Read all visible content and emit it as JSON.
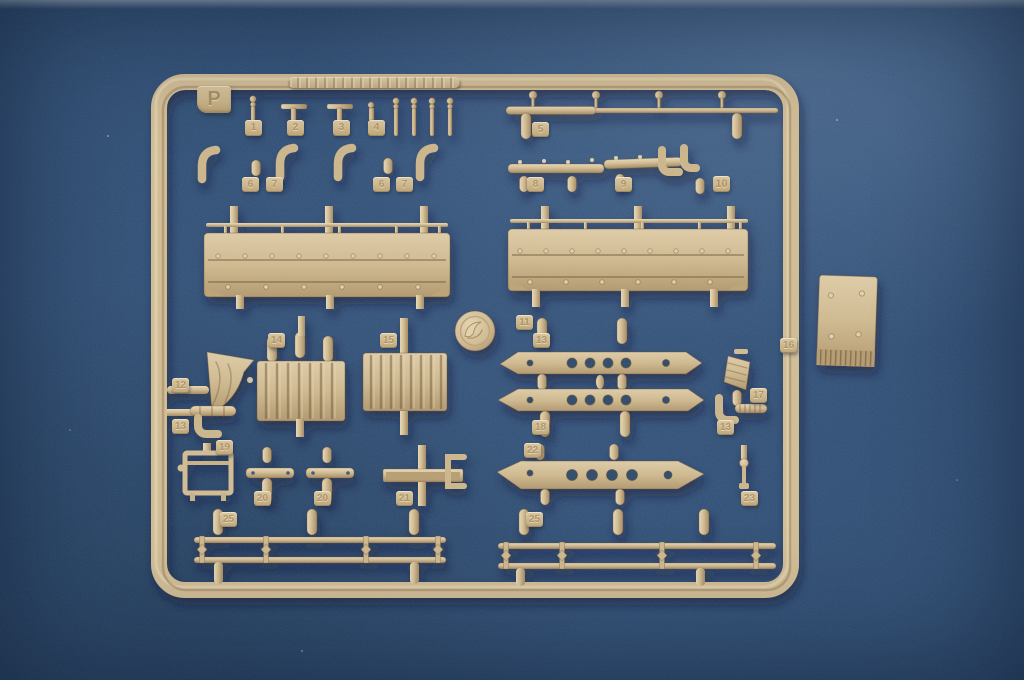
{
  "photo": {
    "subject": "Tan plastic model kit sprue (parts runner) photographed on a blue backdrop",
    "background_color": "#2b4a70",
    "plastic_color": "#d3bc90",
    "plastic_highlight": "#ead9b2",
    "plastic_shadow": "#a5885c"
  },
  "sprue": {
    "letter": "P",
    "logo": "circular-brand-medallion",
    "mold_plate": "embossed manufacturer text (illegible)"
  },
  "tabs": [
    {
      "label": "1"
    },
    {
      "label": "2"
    },
    {
      "label": "3"
    },
    {
      "label": "4"
    },
    {
      "label": "5"
    },
    {
      "label": "6"
    },
    {
      "label": "7"
    },
    {
      "label": "6"
    },
    {
      "label": "7"
    },
    {
      "label": "8"
    },
    {
      "label": "9"
    },
    {
      "label": "10"
    },
    {
      "label": "11"
    },
    {
      "label": "13"
    },
    {
      "label": "14"
    },
    {
      "label": "15"
    },
    {
      "label": "12"
    },
    {
      "label": "16"
    },
    {
      "label": "17"
    },
    {
      "label": "13"
    },
    {
      "label": "19"
    },
    {
      "label": "18"
    },
    {
      "label": "13"
    },
    {
      "label": "22"
    },
    {
      "label": "20"
    },
    {
      "label": "20"
    },
    {
      "label": "21"
    },
    {
      "label": "23"
    },
    {
      "label": "25"
    },
    {
      "label": "25"
    }
  ]
}
